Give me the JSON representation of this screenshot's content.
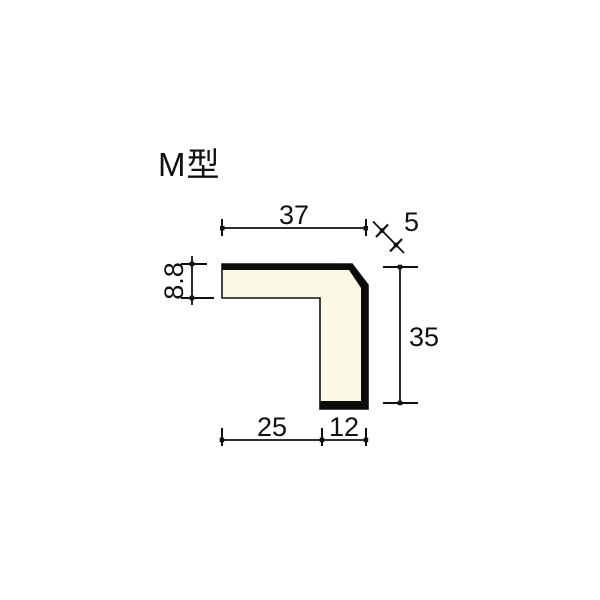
{
  "title": "M型",
  "drawing": {
    "profile_name": "M型",
    "description": "L-shaped corner moulding cross-section diagram with chamfered outer corner",
    "colors": {
      "background": "#ffffff",
      "profile_fill": "#fbf9e6",
      "line": "#111111",
      "surface_band": "#0b0b0b"
    },
    "dimensions": {
      "top_width": "37",
      "corner_chamfer": "5",
      "top_thickness": "8.8",
      "right_height": "35",
      "bottom_inner_width": "25",
      "bottom_leg_width": "12"
    }
  }
}
